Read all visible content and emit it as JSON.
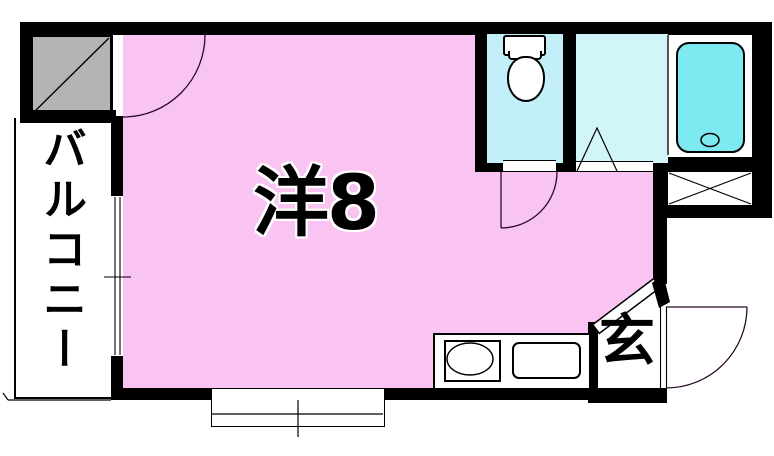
{
  "plan": {
    "labels": {
      "main_room": "洋8",
      "balcony": "バルコニー",
      "entrance": "玄"
    },
    "colors": {
      "main_room_pink": "#f9c4f1",
      "toilet_cyan": "#c3eff9",
      "bathroom_cyan": "#d2f5f9",
      "bathtub_aqua": "#7de9f0",
      "storage_gray": "#b4b4b4",
      "wall_black": "#000000",
      "background_white": "#ffffff"
    },
    "fixtures": {
      "toilet": "toilet-icon",
      "bathtub": "bathtub-icon",
      "kitchen_sink": "sink-ellipse",
      "shaft_marker": "x-cross",
      "storage_marker": "diagonal-hatch",
      "doors": "quarter-circle-swing-arcs",
      "windows": "double-line-sliding-window-symbols"
    }
  }
}
